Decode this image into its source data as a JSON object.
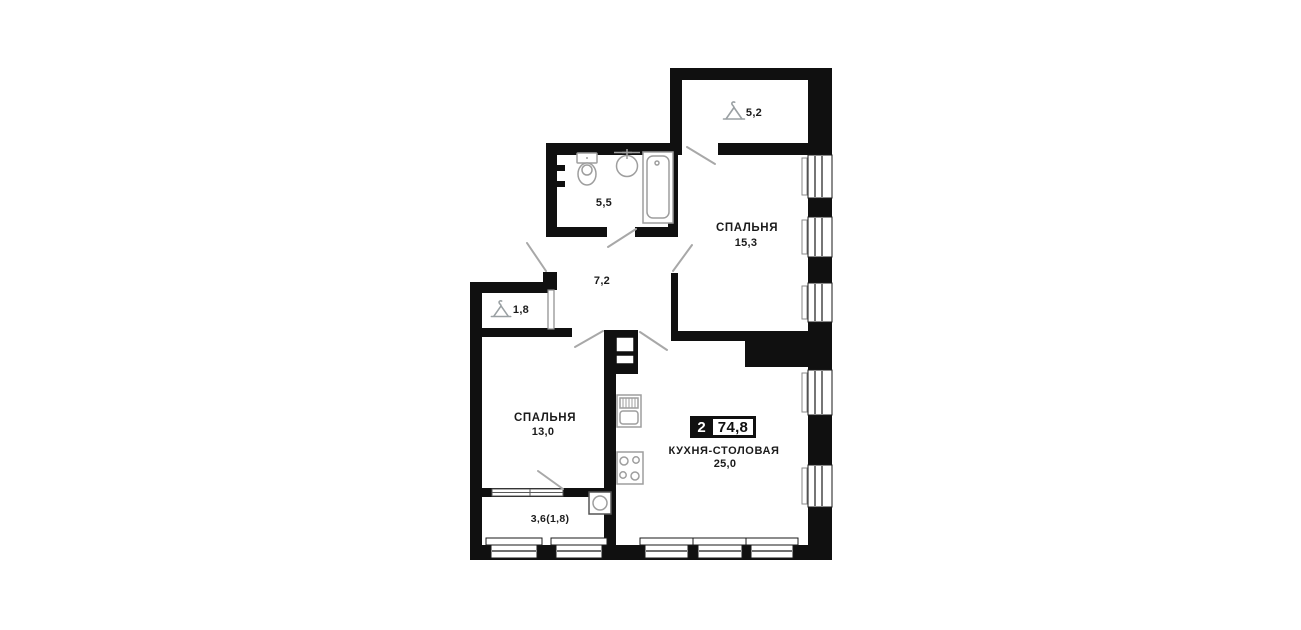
{
  "floor_plan": {
    "badge": {
      "room_count": "2",
      "total_area": "74,8"
    },
    "rooms": {
      "bedroom_large": {
        "name": "СПАЛЬНЯ",
        "area": "15,3"
      },
      "bedroom_small": {
        "name": "СПАЛЬНЯ",
        "area": "13,0"
      },
      "kitchen_dining": {
        "name": "КУХНЯ-СТОЛОВАЯ",
        "area": "25,0"
      },
      "hallway": {
        "area": "7,2"
      },
      "bathroom": {
        "area": "5,5"
      },
      "wardrobe_top": {
        "area": "5,2"
      },
      "wardrobe_side": {
        "area": "1,8"
      },
      "loggia": {
        "area": "3,6(1,8)"
      }
    },
    "colors": {
      "wall": "#101010",
      "fixture_line": "#9e9e9e",
      "door_swing": "#a8a8a8",
      "text": "#1b1b1b"
    }
  }
}
